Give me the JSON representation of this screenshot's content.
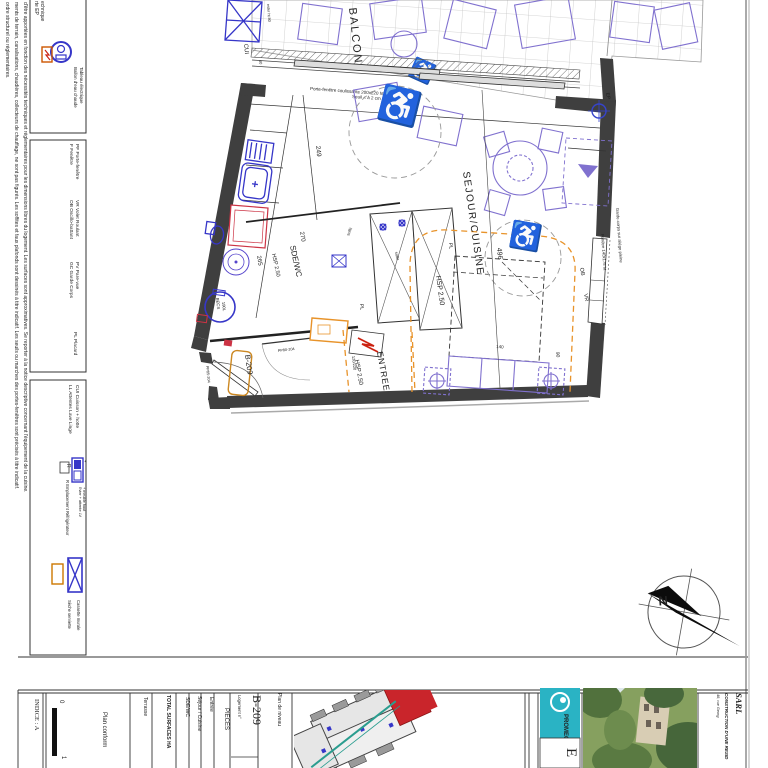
{
  "sidebar": {
    "notes": [
      "d'être apportées en fonction des nécessités techniques et réglementaires pour les dimensions libres du logement. Les surfaces sont approximatives. Se reporter à la notice descriptive concernant l'équipement de la cuisine.",
      "ments de terrain, canalisations, chaudières, collecteurs de chauffage, ne sont pas figurés. Les soffites et faux plafonds sont dessinés à titre indicatif. Les seuils ou marches des portes-fenêtres sont précisés à titre indicatif.",
      "ordre structurel ou réglementaires."
    ],
    "legend_utilities": {
      "item1": "rte EP",
      "item2": "echnique",
      "ballon": "Ballon d'eau chaude",
      "tableau": "Tableau électrique"
    },
    "legend_openings": {
      "pf": "PF  Porte-fenêtre",
      "f": "F  Fenêtre",
      "vr": "VR  Volet Roulant",
      "ob": "OB  Oscillo-battant",
      "pv": "PV  Pare-vue",
      "gc": "GC  Garde Corps",
      "pl": "PL  Placard"
    },
    "legend_kitchen": {
      "cui": "CUI  Cuisson + hotte",
      "ll": "LL  Attentes Lave Linge",
      "evier1": "Evier + attente LV",
      "evier2": "+ meuble haut",
      "refrig": "R  Emplacement Réfrigérateur",
      "cassette": "Cassette murale",
      "seche": "Sèche serviette"
    }
  },
  "plan": {
    "rooms": {
      "balcon": "BALCON",
      "sejour": "SEJOUR/CUISINE",
      "sejour_hsp": "HSP 2.50",
      "entree": "ENTREE",
      "entree_hsp": "HSP 2.50",
      "sde": "SDE/WC",
      "sde_hsp": "HSP 2.50",
      "cui": "CUI"
    },
    "dims": {
      "top": "602",
      "kitchen": "249",
      "sde_w": "270",
      "sde_h": "265",
      "sejour": "496",
      "win": "90",
      "bed": "140",
      "soffit_h": "120/220",
      "num40": "40"
    },
    "labels": {
      "porte_fenetre": "Porte-fenêtre coulissante 200x220 ht VR",
      "seuil": "Seuil < à 2 cm",
      "fenetre": "Fenêtre 140x175 ht",
      "garde_corps": "Garde-corps sur allège pleine",
      "ob": "OB",
      "vr": "VR",
      "ep": "EP",
      "pl_closet": "PL",
      "pl_sde": "PL",
      "becs": "BECS",
      "becs_cap": "190L",
      "unit": "B-209",
      "door_entry": "PP85-204",
      "door_int": "PP80-204",
      "attente": "ester ht 80",
      "soffit1": "soffit",
      "soffit2": "soffit"
    }
  },
  "titleblock": {
    "indice": "INDICE : A",
    "scale0": "0",
    "scale1": "1",
    "plan_conform": "Plan conform",
    "terrasse": "Terrasse",
    "total": "TOTAL SURFACES HA",
    "row_sde": "SDE/WC",
    "row_sejour": "Séjour / Cuisine",
    "row_entree": "Entrée",
    "pieces": "PIECES",
    "logement_label": "Logement n°",
    "logement_no": "B-209",
    "plan_niveau": "Plan de niveau",
    "promeo": "PROMEO",
    "etage": "E",
    "sarl": "SARL",
    "construction": "CONSTRUCTION D'UNE RESID",
    "address": "48, rue Georg"
  },
  "colors": {
    "accent_orange": "#e8932a",
    "fixture_blue": "#3636c8",
    "furniture_purple": "#8071cf",
    "highlight_red": "#c9252b",
    "promeo_teal": "#2ab3c4"
  }
}
